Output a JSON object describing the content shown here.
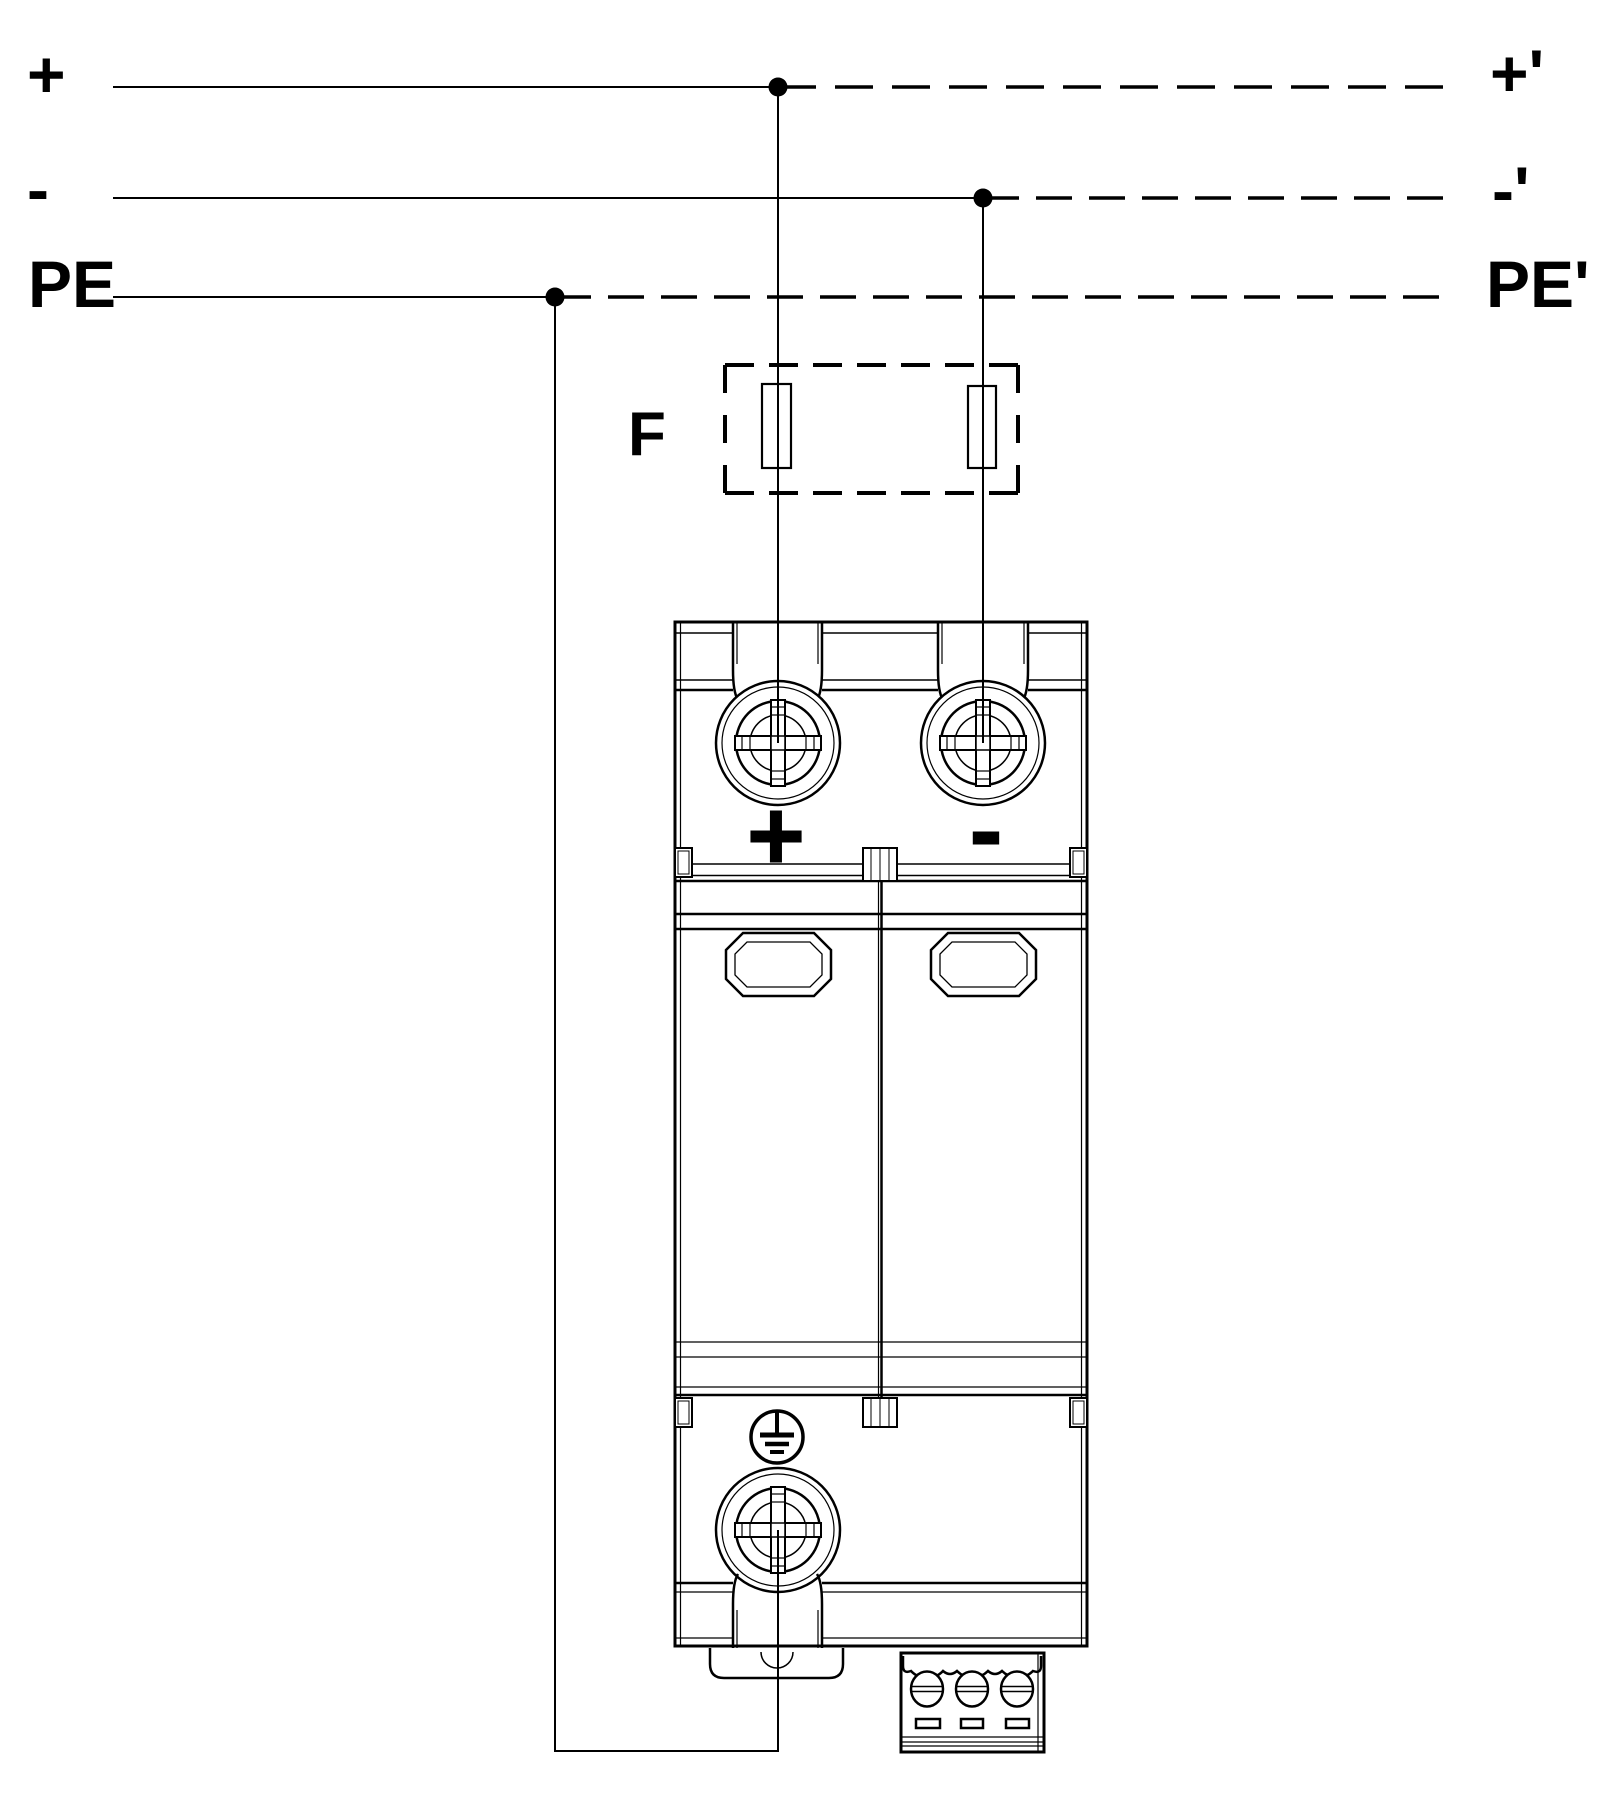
{
  "diagram_type": "spd-surge-protector-dc-wiring-diagram",
  "colors": {
    "line": "#000000",
    "background": "#ffffff"
  },
  "labels": {
    "input_plus": "+",
    "input_minus": "-",
    "input_pe": "PE",
    "output_plus": "+'",
    "output_minus": "-'",
    "output_pe": "PE'",
    "fuse": "F",
    "device_plus": "+",
    "device_minus": "-"
  },
  "rails": {
    "input_side": [
      "+",
      "-",
      "PE"
    ],
    "output_side": [
      "+'",
      "-'",
      "PE'"
    ],
    "style_input": "solid",
    "style_output": "dashed"
  },
  "components": {
    "fuse_box": "F (dashed optional backup fuses on + and - conductors)",
    "device": "2-pole DIN-rail surge protective device with + and - screw terminals, two status windows, PE earth screw terminal and 3-pole remote signalling terminal block"
  }
}
